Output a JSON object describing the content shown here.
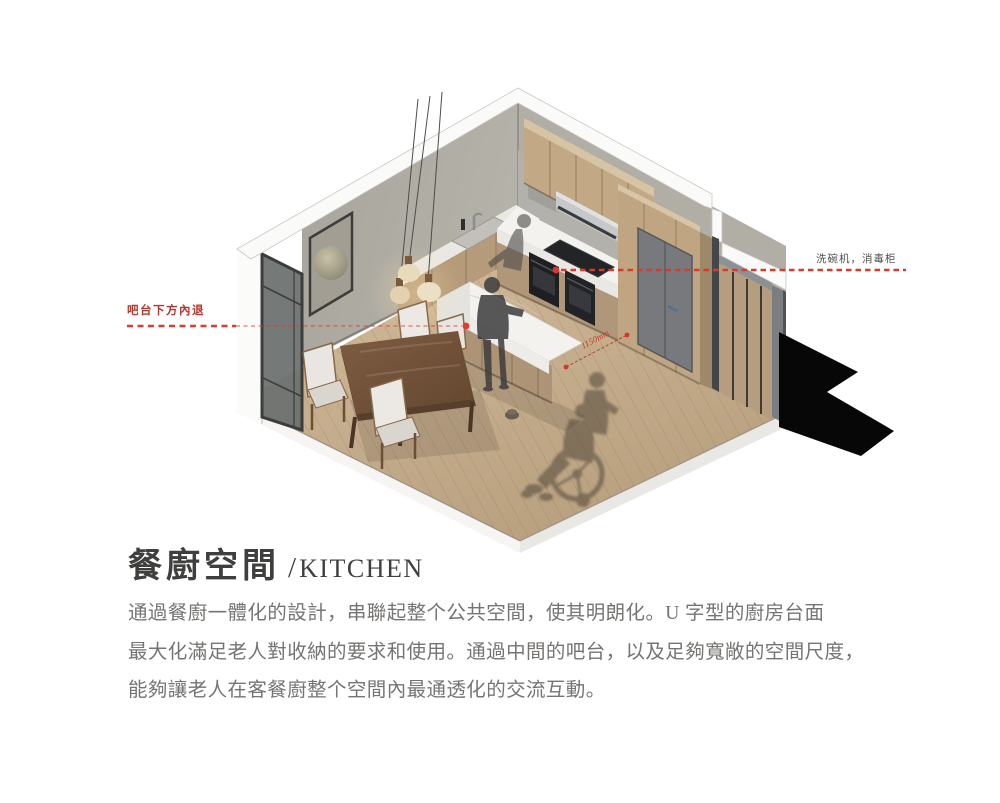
{
  "header": {
    "title_zh": "餐廚空間",
    "title_divider": "/",
    "title_en": "KITCHEN"
  },
  "description": {
    "lines": [
      "通過餐廚一體化的設計，串聯起整个公共空間，使其明朗化。U 字型的廚房台面",
      "最大化滿足老人對收納的要求和使用。通過中間的吧台，以及足夠寬敞的空間尺度，",
      "能夠讓老人在客餐廚整个空間內最通透化的交流互動。"
    ]
  },
  "annotations": {
    "bar_recess": {
      "label": "吧台下方內退"
    },
    "appliances": {
      "label": "洗碗机，消毒柜"
    },
    "dimension": {
      "label": "1150mm"
    }
  },
  "palette": {
    "annotation_red": "#e04029",
    "annotation_red_text": "#b4372c",
    "annotation_gray_text": "#504f4d",
    "title_color": "#3f3f3e",
    "body_text": "#767472",
    "wood_cabinet": "#c0a683",
    "wood_floor": "#c8af8e",
    "wall_gray": "#abA89f",
    "marble": "#f3f2ef",
    "silhouette": "#3e3d3d"
  }
}
